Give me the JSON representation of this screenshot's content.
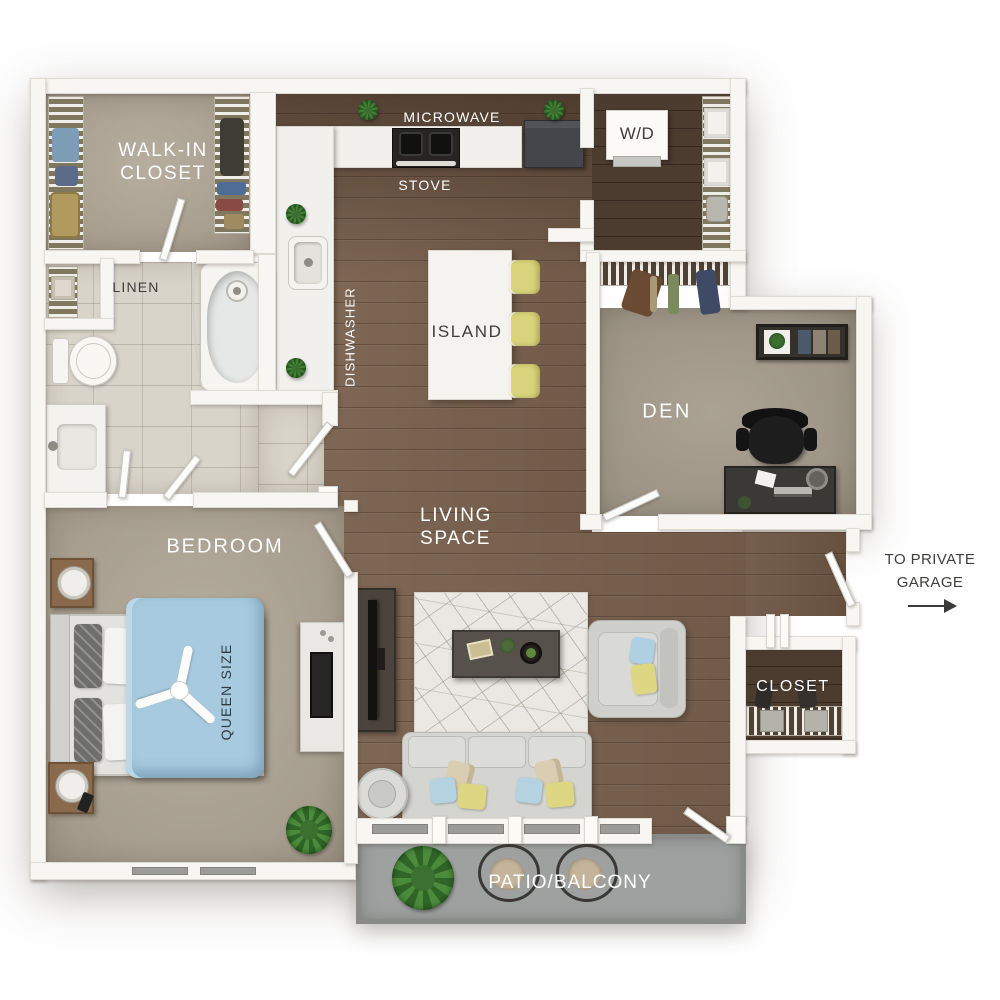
{
  "palette": {
    "wall": "#f7f6f2",
    "wood_floor": "#7a614e",
    "dark_wood": "#4c3b2f",
    "carpet": "#ada496",
    "bath_tile": "#d8d4ca",
    "patio_concrete": "#9ea19f",
    "duvet_blue": "#a7cade",
    "accent_yellow": "#d9d37c",
    "accent_blue": "#aed0e2",
    "label_white": "#ffffff",
    "label_dark": "#3e3d39"
  },
  "labels": {
    "walk_in_line1": "WALK-IN",
    "walk_in_line2": "CLOSET",
    "linen": "LINEN",
    "microwave": "MICROWAVE",
    "stove": "STOVE",
    "dishwasher": "DISHWASHER",
    "island": "ISLAND",
    "washer_dryer": "W/D",
    "den": "DEN",
    "living_line1": "LIVING",
    "living_line2": "SPACE",
    "bedroom": "BEDROOM",
    "queen_size": "QUEEN SIZE",
    "closet": "CLOSET",
    "garage_line1": "TO PRIVATE",
    "garage_line2": "GARAGE",
    "patio": "PATIO/BALCONY"
  }
}
